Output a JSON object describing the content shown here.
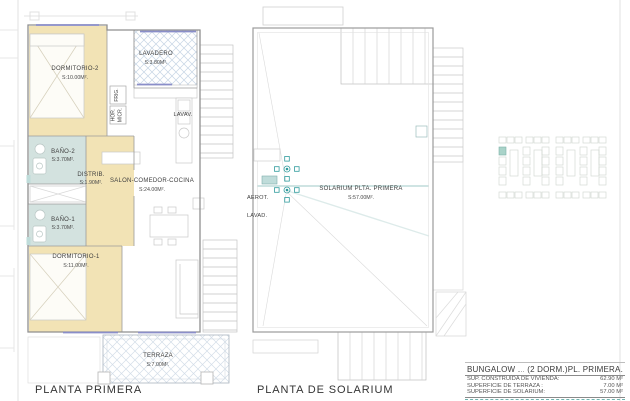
{
  "sheet": {
    "plan1_title": "PLANTA PRIMERA",
    "plan2_title": "PLANTA DE SOLARIUM"
  },
  "plan1": {
    "rooms": [
      {
        "name": "DORMITORIO-2",
        "area": "S:10.00M²."
      },
      {
        "name": "LAVADERO",
        "area": "S:3.80M²."
      },
      {
        "name": "BAÑO-2",
        "area": "S:3.70M²."
      },
      {
        "name": "DISTRIB.",
        "area": "S:1.90M²."
      },
      {
        "name": "SALON-COMEDOR-COCINA",
        "area": "S:24.00M²."
      },
      {
        "name": "BAÑO-1",
        "area": "S:3.70M²."
      },
      {
        "name": "DORMITORIO-1",
        "area": "S:11.00M²."
      },
      {
        "name": "TERRAZA",
        "area": "S:7.00M²."
      }
    ],
    "fixtures": {
      "lavav": "LAVAV.",
      "frig": "FRIG.",
      "hor": "HOR.",
      "micr": "MICR."
    }
  },
  "plan2": {
    "room_name": "SOLARIUM PLTA. PRIMERA",
    "room_area": "S:57.00M².",
    "aerot": "AEROT.",
    "lavad": "LAVAD."
  },
  "titleblock": {
    "name": "BUNGALOW",
    "dorms": "(2 DORM.)",
    "floor": "PL. PRIMERA.",
    "rows": [
      {
        "label": "SUP. CONSTRUIDA DE VIVIENDA:",
        "value": "62.90 M²"
      },
      {
        "label": "SUPERFICIE DE TERRAZA :",
        "value": "7.00 M²"
      },
      {
        "label": "SUPERFICIE DE SOLARIUM:",
        "value": "57.00 M²"
      }
    ]
  },
  "colors": {
    "room_beige": "#f2e3b5",
    "room_teal": "#d3e2df",
    "accent_teal": "#2f9b9d",
    "window_blue": "#8a8ec9",
    "hatch_blue": "#c6d4e4",
    "wall_gray": "#8f8f8f",
    "text": "#3c3c3c"
  }
}
